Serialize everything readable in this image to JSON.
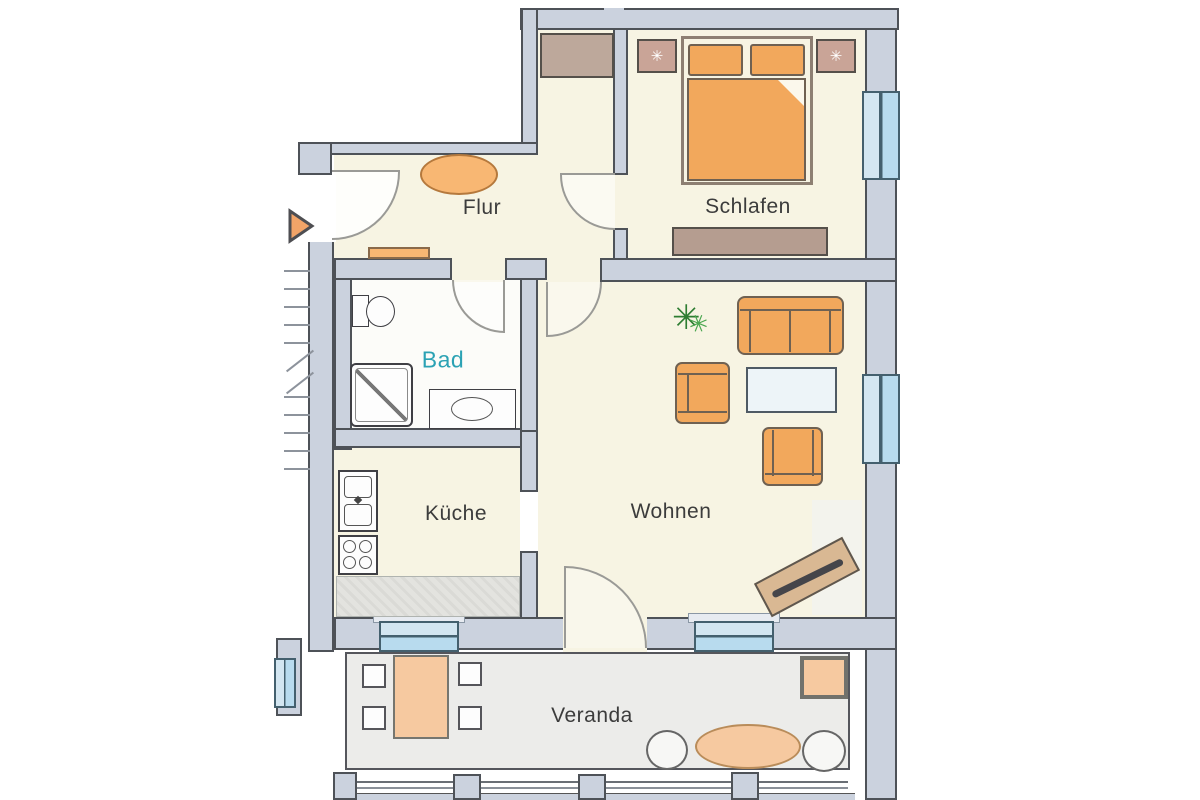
{
  "plan": {
    "rooms": {
      "flur": "Flur",
      "schlafen": "Schlafen",
      "bad": "Bad",
      "kueche": "Küche",
      "wohnen": "Wohnen",
      "veranda": "Veranda"
    }
  },
  "colors": {
    "wall_fill": "#cbd2de",
    "wall_line": "#4e5258",
    "floor_cream": "#f7f4e3",
    "floor_bath": "#fcfcf9",
    "floor_veranda": "#ececea",
    "window_frame": "#44606e",
    "window_blue": "#c3e0f1",
    "furniture_orange": "#f2a85c",
    "furniture_peach": "#f6c9a0",
    "rug_orange": "#f8b773",
    "wood_brown": "#b59d90",
    "wood_light": "#c9a497",
    "sideboard_tan": "#d9b893",
    "plant_green": "#2f8f35",
    "door_arc": "#9a9a96",
    "label_color": "#3c3c3c",
    "bad_label_color": "#2ba2b4",
    "arrow_orange": "#f2a468",
    "stair_line": "#8d939c",
    "counter_gray": "#e3e3df"
  }
}
